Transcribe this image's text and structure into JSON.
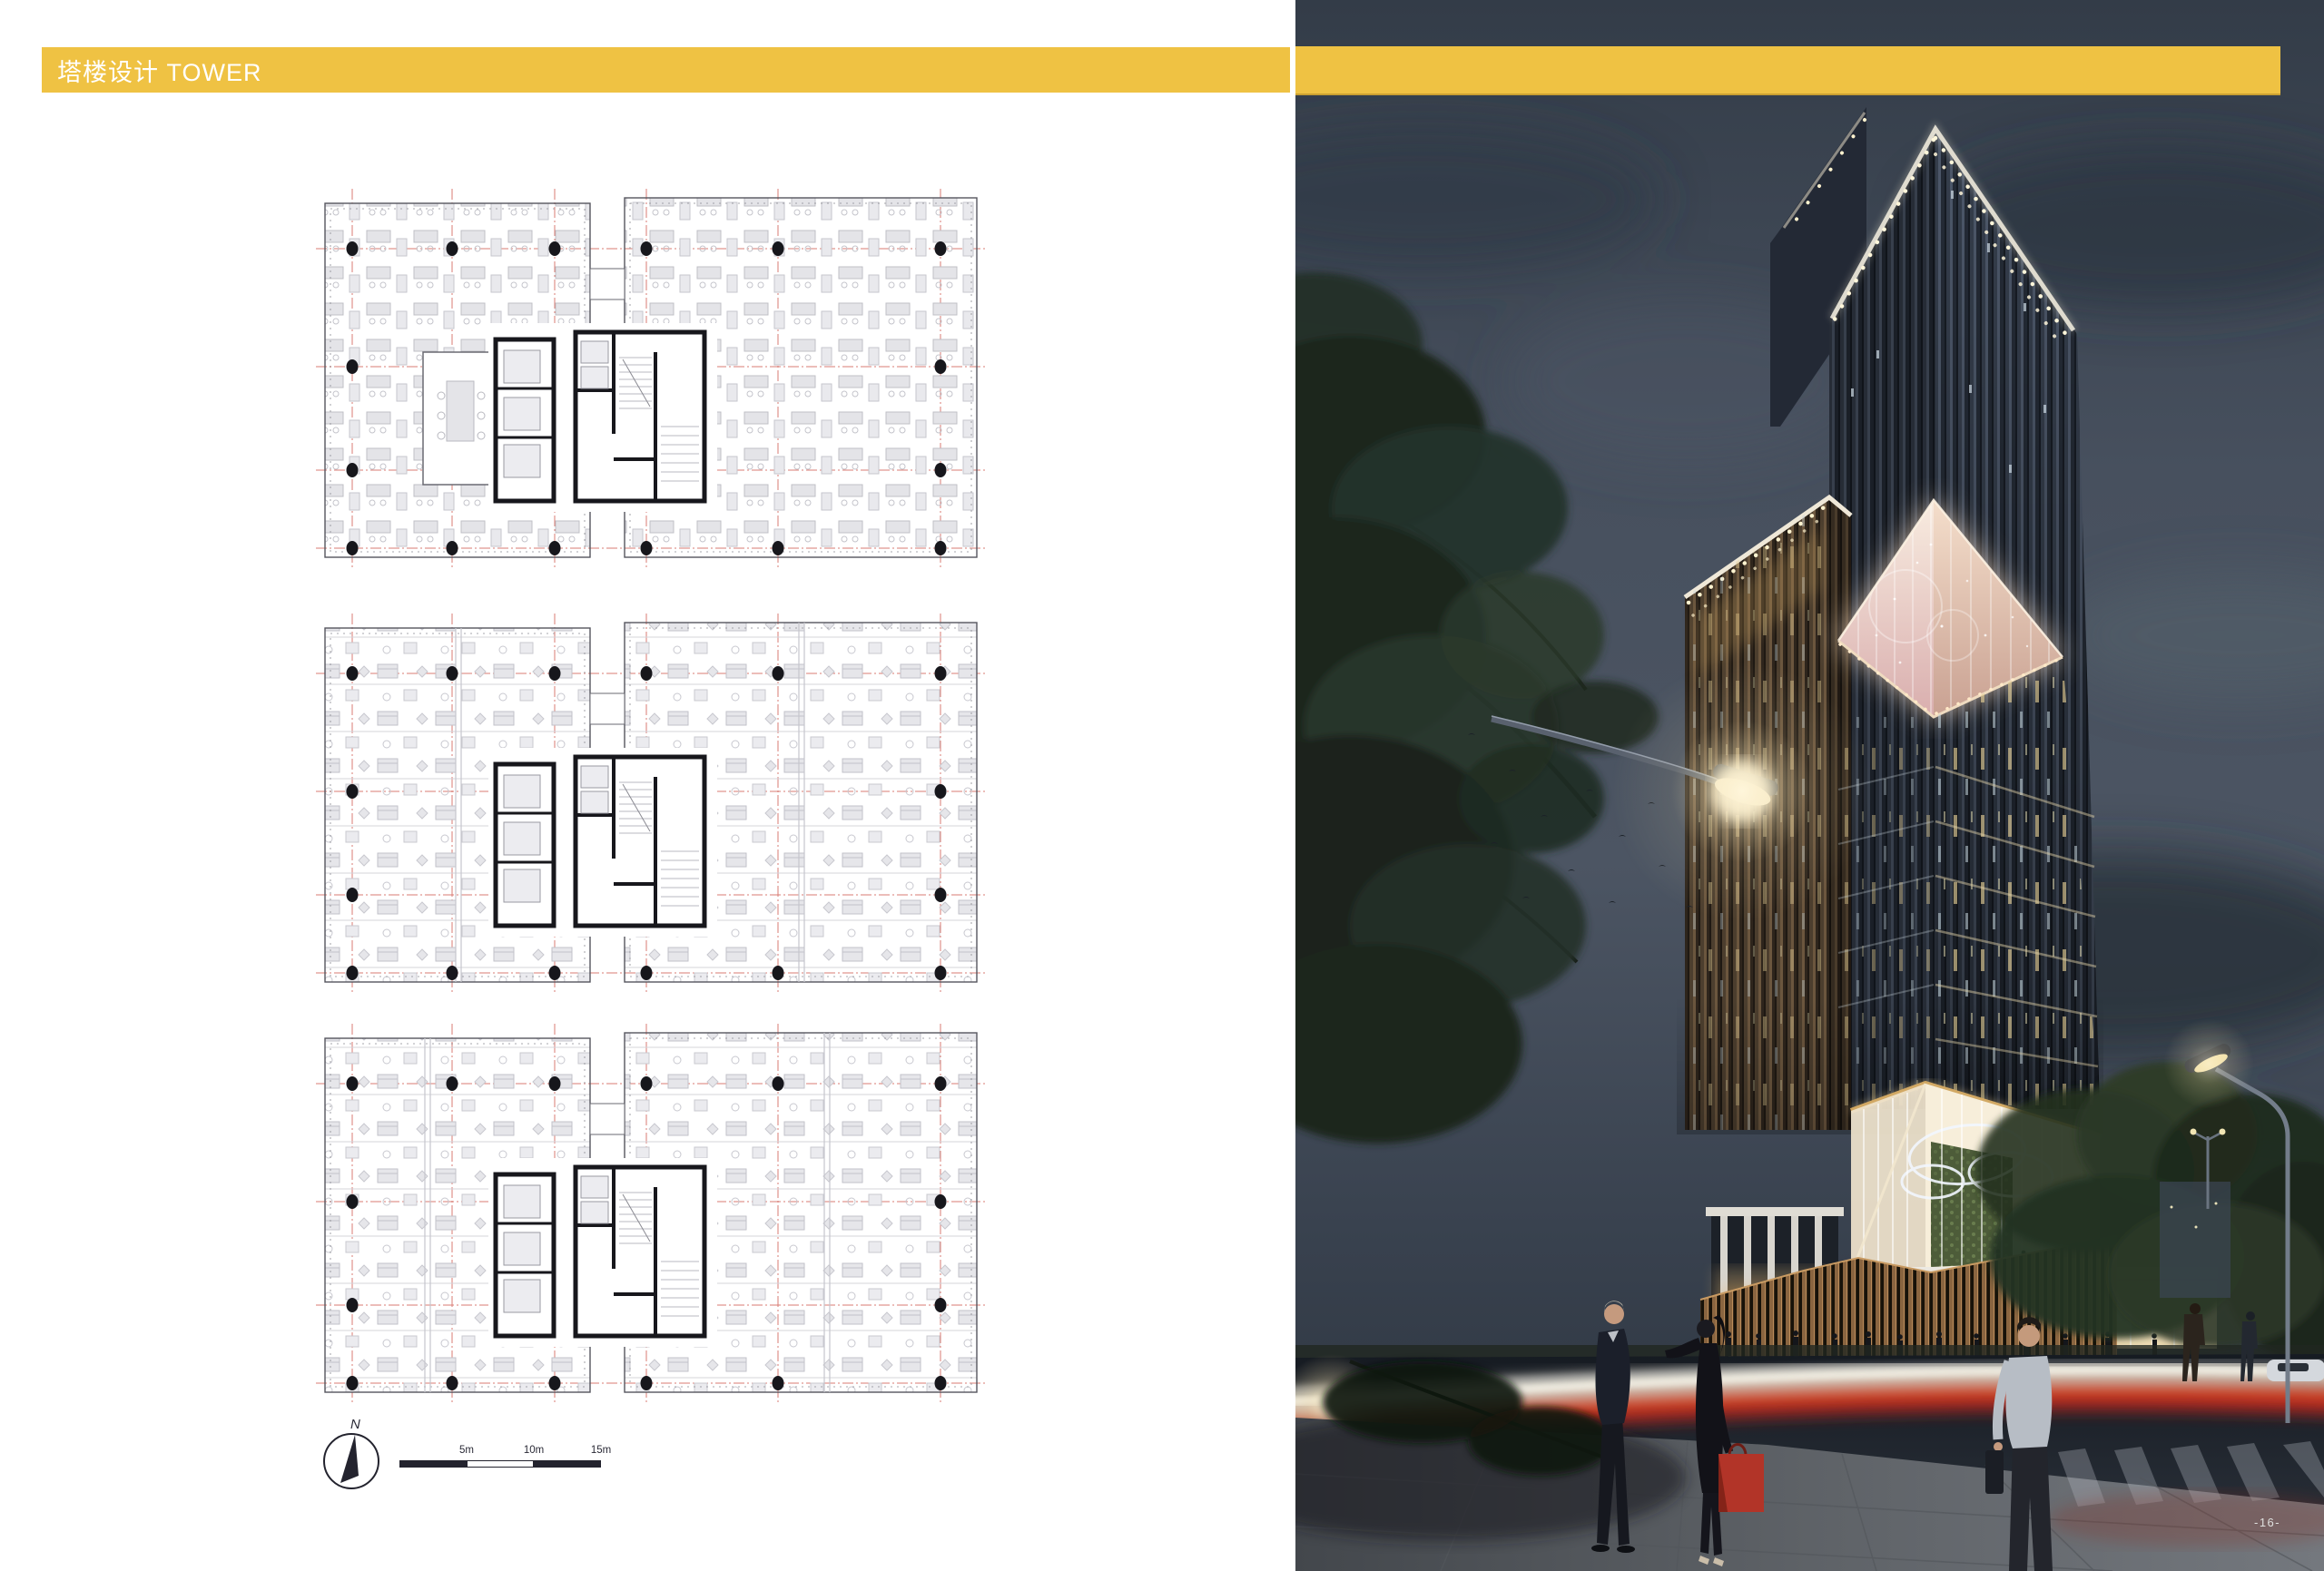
{
  "header": {
    "title": "塔楼设计 TOWER",
    "accent_color": "#EFC243",
    "text_color": "#FFFFFF"
  },
  "floor_plans": {
    "count": 3,
    "grid_color": "#D97B73",
    "wall_color": "#17171C",
    "furniture_color": "#D9D9DE"
  },
  "compass": {
    "north_label": "N"
  },
  "scale_bar": {
    "labels": [
      "5m",
      "10m",
      "15m"
    ],
    "bar_color": "#23232E"
  },
  "photo": {
    "page_number": "-16-",
    "sky_color": "#46505E",
    "facade_bronze": "#5A4936",
    "facade_glass": "#39404D",
    "glow_color": "#F3DDC2",
    "trail_red": "#C23127",
    "trail_white": "#F7F0E0"
  }
}
